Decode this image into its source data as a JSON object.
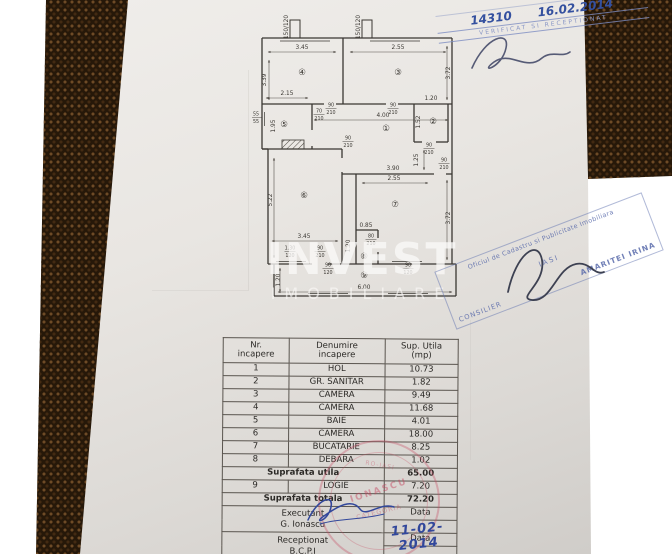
{
  "watermark": {
    "line1": "INVEST",
    "line2": "IMOBILIARE"
  },
  "plan": {
    "rooms": [
      {
        "t": "④",
        "x": 50,
        "y": 67
      },
      {
        "t": "③",
        "x": 146,
        "y": 67
      },
      {
        "t": "⑤",
        "x": 32,
        "y": 119
      },
      {
        "t": "①",
        "x": 134,
        "y": 123
      },
      {
        "t": "②",
        "x": 181,
        "y": 116
      },
      {
        "t": "⑥",
        "x": 52,
        "y": 190
      },
      {
        "t": "⑦",
        "x": 143,
        "y": 199
      },
      {
        "t": "⑧",
        "x": 112,
        "y": 251
      },
      {
        "t": "⑨",
        "x": 112,
        "y": 270
      }
    ],
    "dims": [
      {
        "t": "3.45",
        "x": 50,
        "y": 41
      },
      {
        "t": "2.55",
        "x": 146,
        "y": 41
      },
      {
        "t": "3.39",
        "x": 14,
        "y": 72,
        "r": -90
      },
      {
        "t": "3.72",
        "x": 198,
        "y": 65,
        "r": -90
      },
      {
        "t": "2.15",
        "x": 35,
        "y": 87
      },
      {
        "t": "1.95",
        "x": 23,
        "y": 118,
        "r": -90
      },
      {
        "t": "55/55",
        "x": 4,
        "y": 109,
        "st": 1
      },
      {
        "t": "70/210",
        "x": 67,
        "y": 106,
        "st": 1
      },
      {
        "t": "90/210",
        "x": 79,
        "y": 100,
        "st": 1
      },
      {
        "t": "90/210",
        "x": 141,
        "y": 100,
        "st": 1
      },
      {
        "t": "4.00",
        "x": 131,
        "y": 109
      },
      {
        "t": "1.20",
        "x": 179,
        "y": 92
      },
      {
        "t": "1.52",
        "x": 168,
        "y": 114,
        "r": -90
      },
      {
        "t": "90/210",
        "x": 177,
        "y": 140,
        "st": 1
      },
      {
        "t": "1.25",
        "x": 166,
        "y": 152,
        "r": -90
      },
      {
        "t": "90/210",
        "x": 192,
        "y": 155,
        "st": 1
      },
      {
        "t": "90/210",
        "x": 96,
        "y": 133,
        "st": 1
      },
      {
        "t": "3.90",
        "x": 141,
        "y": 162
      },
      {
        "t": "5.22",
        "x": 20,
        "y": 192,
        "r": -90
      },
      {
        "t": "3.45",
        "x": 52,
        "y": 230
      },
      {
        "t": "2.55",
        "x": 142,
        "y": 172
      },
      {
        "t": "3.72",
        "x": 198,
        "y": 210,
        "r": -90
      },
      {
        "t": "0.85",
        "x": 114,
        "y": 219
      },
      {
        "t": "1.20",
        "x": 98,
        "y": 238,
        "r": -90
      },
      {
        "t": "80/210",
        "x": 119,
        "y": 231,
        "st": 1
      },
      {
        "t": "90/210",
        "x": 68,
        "y": 243,
        "st": 1
      },
      {
        "t": "1.30/120",
        "x": 38,
        "y": 243,
        "st": 1
      },
      {
        "t": "6.00",
        "x": 112,
        "y": 281
      },
      {
        "t": "1.20",
        "x": 28,
        "y": 272,
        "r": -90
      },
      {
        "t": "90/120",
        "x": 76,
        "y": 260,
        "st": 1
      },
      {
        "t": "90/120",
        "x": 156,
        "y": 260,
        "st": 1
      },
      {
        "t": "150/120",
        "x": 36,
        "y": 19,
        "r": -90
      },
      {
        "t": "150/120",
        "x": 108,
        "y": 19,
        "r": -90
      }
    ]
  },
  "table": {
    "header": {
      "col1a": "Nr.",
      "col1b": "incapere",
      "col2a": "Denumire",
      "col2b": "incapere",
      "col3a": "Sup. Utila",
      "col3b": "(mp)"
    },
    "rows": [
      {
        "nr": "1",
        "name": "HOL",
        "area": "10.73"
      },
      {
        "nr": "2",
        "name": "GR. SANITAR",
        "area": "1.82"
      },
      {
        "nr": "3",
        "name": "CAMERA",
        "area": "9.49"
      },
      {
        "nr": "4",
        "name": "CAMERA",
        "area": "11.68"
      },
      {
        "nr": "5",
        "name": "BAIE",
        "area": "4.01"
      },
      {
        "nr": "6",
        "name": "CAMERA",
        "area": "18.00"
      },
      {
        "nr": "7",
        "name": "BUCATARIE",
        "area": "8.25"
      },
      {
        "nr": "8",
        "name": "DEBARA",
        "area": "1.02"
      }
    ],
    "totals1": {
      "label": "Suprafata utila",
      "value": "65.00"
    },
    "row9": {
      "nr": "9",
      "name": "LOGIE",
      "area": "7.20"
    },
    "totals2": {
      "label": "Suprafata totala",
      "value": "72.20"
    },
    "executant": {
      "label": "Executant",
      "name": "G. Ionascu",
      "data_label": "Data"
    },
    "receptionat": {
      "label": "Receptionat",
      "name": "B.C.P.I",
      "data_label": "Data",
      "date": "11-02-2014"
    }
  },
  "stamps": {
    "top_right": {
      "number": "14310",
      "date": "16.02.2014",
      "stamp_line": "VERIFICAT SI RECEPTIONAT"
    },
    "ocpi": {
      "line1": "Oficiul de Cadastru si Publicitate Imobiliara",
      "line2": "IASI",
      "name": "AMARITEI IRINA",
      "role": "CONSILIER"
    },
    "round": {
      "name": "IONASCU",
      "bottom": "CATEGORIA",
      "top": "RO-IASI"
    }
  },
  "colors": {
    "ink": "#3a3732",
    "stamp_blue": "#34509f",
    "stamp_red": "#c34a5d",
    "paper": "#e9e6e2"
  }
}
